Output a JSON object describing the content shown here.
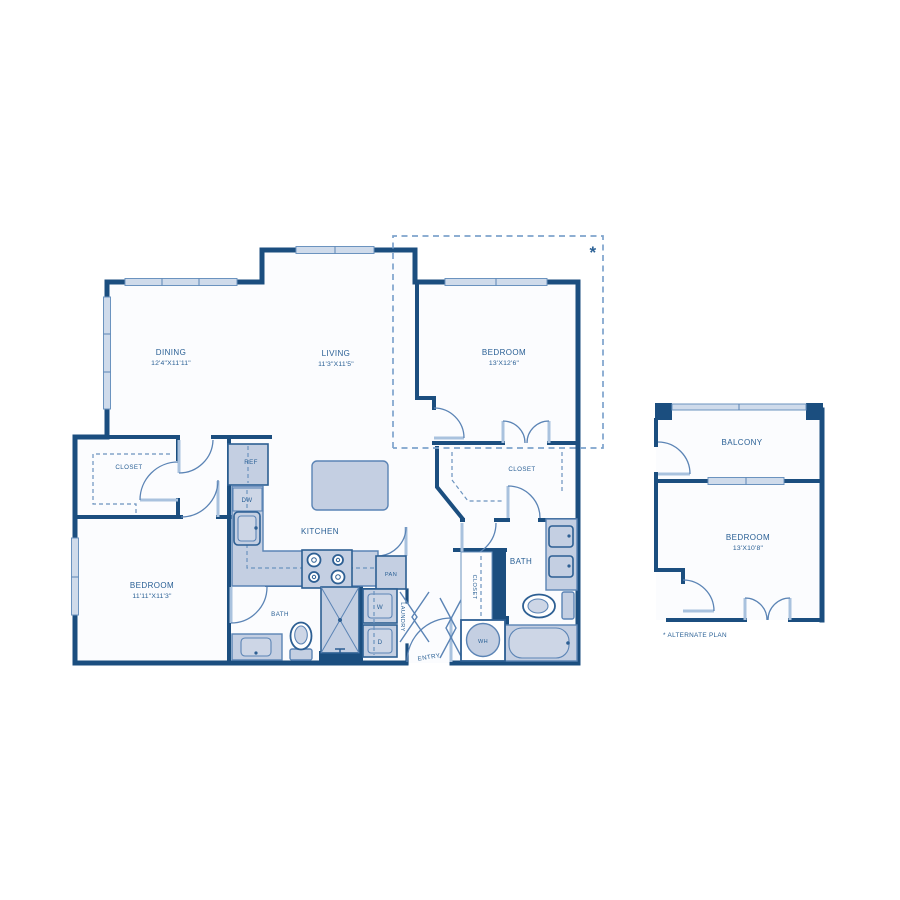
{
  "colors": {
    "wall": "#1b4e7f",
    "fixture": "#c4cfe2",
    "accent": "#5b84b5",
    "text": "#2a6095",
    "window": "#cfdbeb",
    "dashed_boundary": "#7da3cc"
  },
  "main_plan": {
    "dining": {
      "label": "DINING",
      "dims": "12'4\"X11'11\""
    },
    "living": {
      "label": "LIVING",
      "dims": "11'3\"X11'5\""
    },
    "bedroom_upper": {
      "label": "BEDROOM",
      "dims": "13'X12'6\""
    },
    "bedroom_lower": {
      "label": "BEDROOM",
      "dims": "11'11\"X11'3\""
    },
    "kitchen": {
      "label": "KITCHEN"
    },
    "closet_upper_left": {
      "label": "CLOSET"
    },
    "closet_walk_in": {
      "label": "CLOSET"
    },
    "closet_hall": {
      "label": "CLOSET"
    },
    "bath_left": {
      "label": "BATH"
    },
    "bath_right": {
      "label": "BATH"
    },
    "pantry": {
      "label": "PAN"
    },
    "laundry": {
      "label": "LAUNDRY"
    },
    "washer": {
      "label": "W"
    },
    "dryer": {
      "label": "D"
    },
    "refrigerator": {
      "label": "REF"
    },
    "dishwasher": {
      "label": "DW"
    },
    "water_heater": {
      "label": "WH"
    },
    "entry": {
      "label": "ENTRY"
    },
    "alternate_marker": "*"
  },
  "alternate_plan": {
    "balcony": {
      "label": "BALCONY"
    },
    "bedroom": {
      "label": "BEDROOM",
      "dims": "13'X10'8\""
    },
    "footnote": "* ALTERNATE PLAN"
  }
}
